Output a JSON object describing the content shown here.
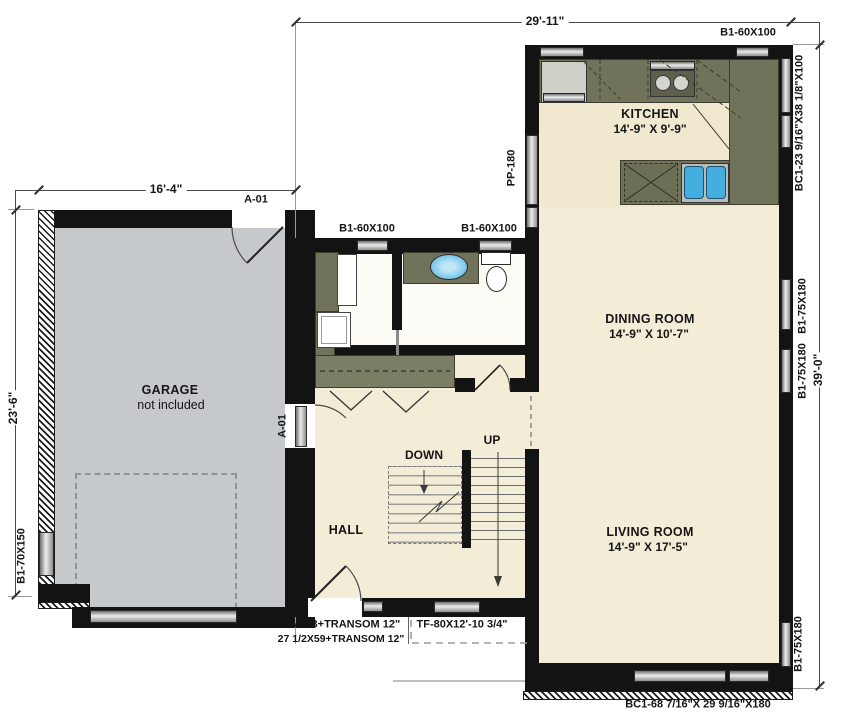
{
  "dimensions": {
    "overall_width": "29'-11\"",
    "overall_height": "39'-0\"",
    "garage_width": "16'-4\"",
    "garage_depth": "23'-6\""
  },
  "rooms": {
    "kitchen": {
      "name": "KITCHEN",
      "size": "14'-9\" X 9'-9\""
    },
    "dining": {
      "name": "DINING ROOM",
      "size": "14'-9\" X 10'-7\""
    },
    "living": {
      "name": "LIVING ROOM",
      "size": "14'-9\" X 17'-5\""
    },
    "garage": {
      "name": "GARAGE",
      "note": "not included"
    },
    "hall": {
      "name": "HALL"
    },
    "stair_up": "UP",
    "stair_down": "DOWN"
  },
  "openings": {
    "b1_60x100_top": "B1-60X100",
    "bc1_kitchen": "BC1-23 9/16\"X38 1/8\"X100",
    "b1_75x180_a": "B1-75X180",
    "b1_75x180_b": "B1-75X180",
    "b1_75x180_c": "B1-75X180",
    "bc1_living": "BC1-68 7/16\"X 29 9/16\"X180",
    "pp_180": "PP-180",
    "b1_60x100_mud_a": "B1-60X100",
    "b1_60x100_mud_b": "B1-60X100",
    "b1_70x150": "B1-70X150",
    "a01_rear": "A-01",
    "a01_hall": "A-01",
    "a13_line1": "A-13+TRANSOM 12\"",
    "a13_line2": "27 1/2X59+TRANSOM 12\"",
    "tf": "TF-80X12'-10 3/4\""
  },
  "colors": {
    "wall": "#131313",
    "floor": "#f3edd8",
    "kitchen_floor": "#f0e8cf",
    "garage_floor": "#c6c9cb",
    "counter": "#71725a",
    "sink_blue": "#45aede",
    "window_silver": "#d8d8d8"
  }
}
